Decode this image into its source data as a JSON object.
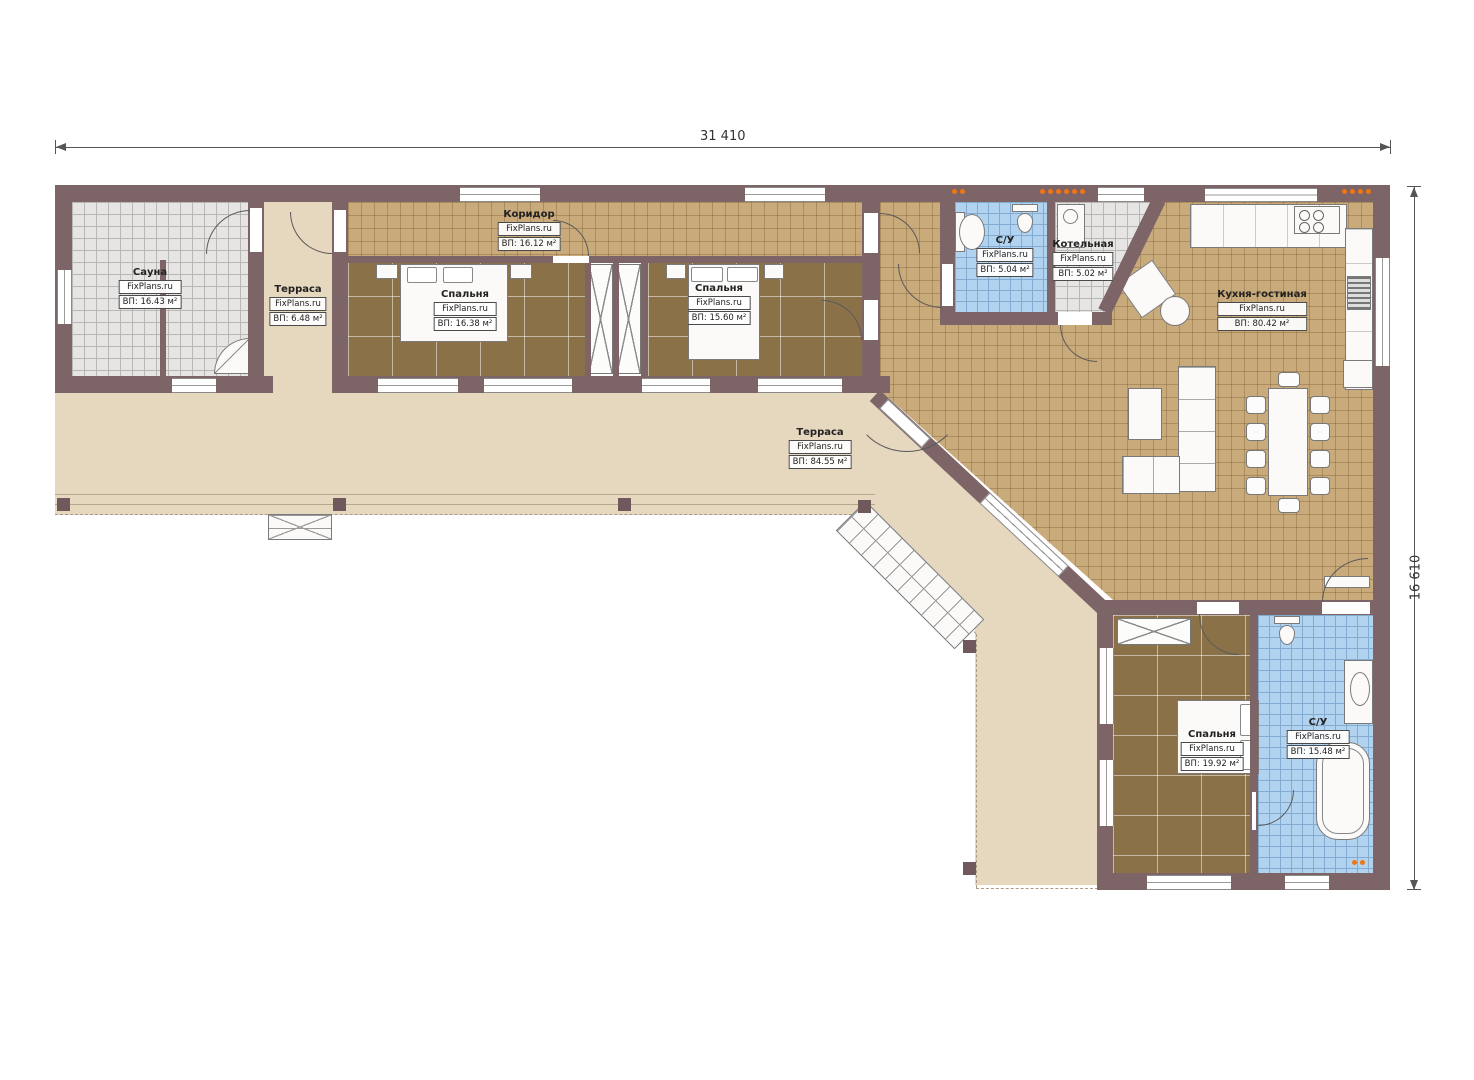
{
  "watermark": "FixPlans.ru",
  "dimensions": {
    "top": "31 410",
    "right": "16 610"
  },
  "rooms": [
    {
      "name": "Сауна",
      "area": "ВП: 16.43 м²"
    },
    {
      "name": "Терраса",
      "area": "ВП: 6.48 м²"
    },
    {
      "name": "Коридор",
      "area": "ВП: 16.12 м²"
    },
    {
      "name": "Спальня",
      "area": "ВП: 16.38 м²"
    },
    {
      "name": "Спальня",
      "area": "ВП: 15.60 м²"
    },
    {
      "name": "С/У",
      "area": "ВП: 5.04 м²"
    },
    {
      "name": "Котельная",
      "area": "ВП: 5.02 м²"
    },
    {
      "name": "Кухня-гостиная",
      "area": "ВП: 80.42 м²"
    },
    {
      "name": "Терраса",
      "area": "ВП: 84.55 м²"
    },
    {
      "name": "Спальня",
      "area": "ВП: 19.92 м²"
    },
    {
      "name": "С/У",
      "area": "ВП: 15.48 м²"
    }
  ],
  "colors": {
    "wall": "#7c6467",
    "tile_floor": "#c9aa7b",
    "parquet_floor": "#8b7148",
    "terrace_floor": "#e6d7bf",
    "bathroom_tile": "#b2d3f0",
    "sauna_tile": "#e6e5e3",
    "radiator": "#ef7615"
  }
}
